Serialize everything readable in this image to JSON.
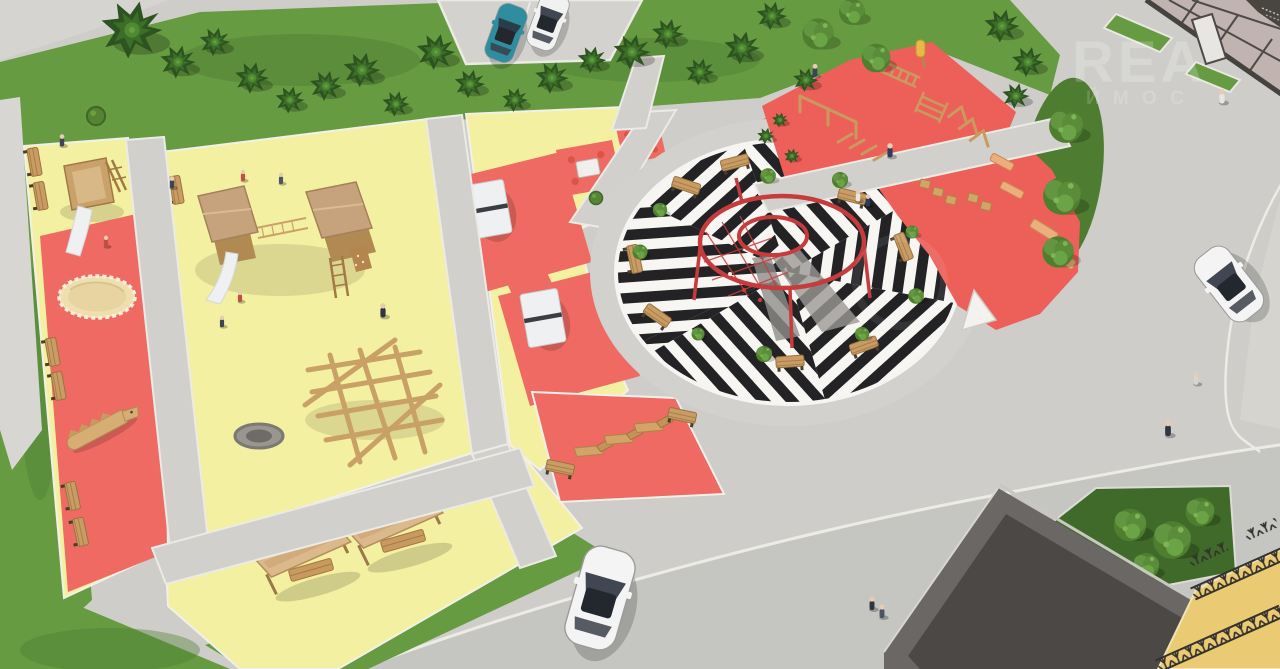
{
  "watermark": {
    "brand": "REA",
    "subline": "Й М О С"
  },
  "colors": {
    "pavement": "#cecdc9",
    "road": "#c2c1bd",
    "road_light": "#d8d6d1",
    "curb": "#edebe5",
    "path": "#d1d0cc",
    "grass": "#679b42",
    "grass_dark": "#4e7c31",
    "play_yellow": "#f4f0a1",
    "play_red": "#ee6a62",
    "workout_red": "#ed6059",
    "stripe_white": "#f7f6f3",
    "wood": "#c99c63",
    "roof_tan": "#c6a37d",
    "slide_white": "#eef0f2",
    "sand": "#efdfae",
    "ring_red": "#c63c3d",
    "car_teal": "#2f8da0",
    "car_white": "#f1f1f2",
    "glass": "#c0b3b0",
    "frame_dark": "#49463f",
    "building_edge": "#6b6764",
    "building_roof": "#4b4846",
    "walkway_yellow": "#eaca72",
    "lattice": "#34322e",
    "sail_white": "#f3f2ef",
    "watermark_white": "#ffffff"
  }
}
